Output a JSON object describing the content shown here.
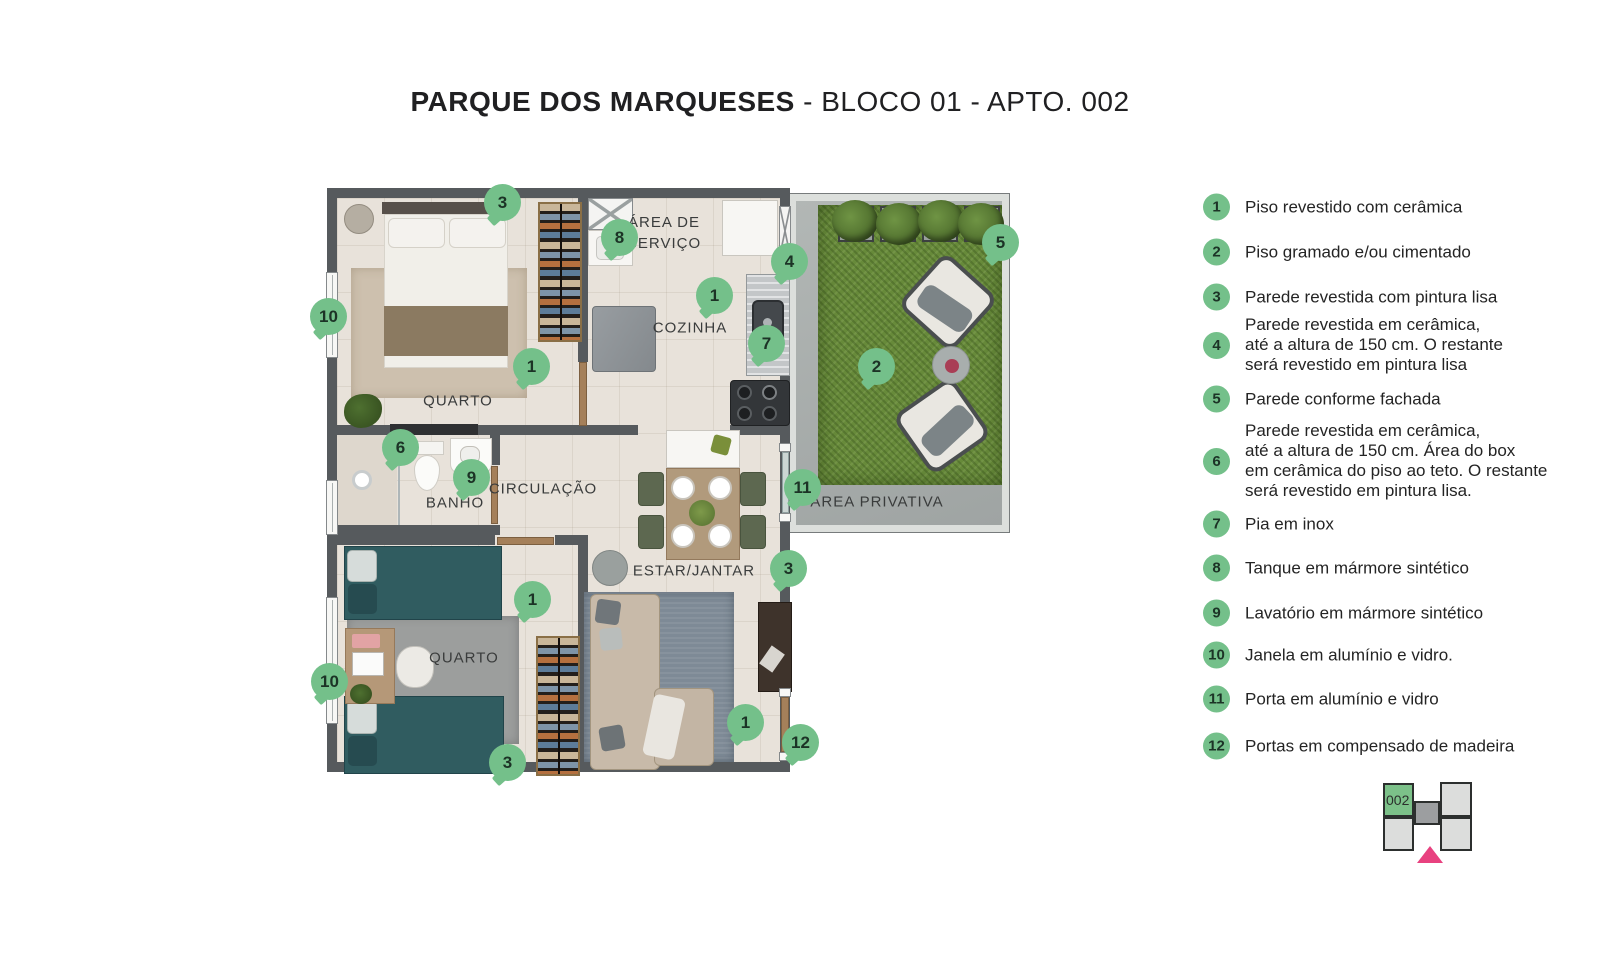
{
  "title": {
    "project": "PARQUE DOS MARQUESES",
    "suffix": " - BLOCO 01 - APTO. 002"
  },
  "colors": {
    "marker_green": "#74c08a",
    "grass_green": "#678a3a",
    "wall_gray": "#565a5d",
    "keyplan_pink": "#e8417f"
  },
  "plan": {
    "room_labels": [
      {
        "id": "area-servico",
        "text": "ÁREA DE\nSERVIÇO",
        "x": 664,
        "y": 233
      },
      {
        "id": "cozinha",
        "text": "COZINHA",
        "x": 690,
        "y": 328
      },
      {
        "id": "quarto-1",
        "text": "QUARTO",
        "x": 458,
        "y": 401
      },
      {
        "id": "banho",
        "text": "BANHO",
        "x": 455,
        "y": 503
      },
      {
        "id": "circulacao",
        "text": "CIRCULAÇÃO",
        "x": 543,
        "y": 489
      },
      {
        "id": "estar-jantar",
        "text": "ESTAR/JANTAR",
        "x": 694,
        "y": 571
      },
      {
        "id": "quarto-2",
        "text": "QUARTO",
        "x": 464,
        "y": 658
      },
      {
        "id": "area-privativa",
        "text": "ÁREA PRIVATIVA",
        "x": 877,
        "y": 502
      }
    ],
    "markers": [
      {
        "n": "3",
        "x": 502,
        "y": 202
      },
      {
        "n": "8",
        "x": 619,
        "y": 237
      },
      {
        "n": "4",
        "x": 789,
        "y": 261
      },
      {
        "n": "5",
        "x": 1000,
        "y": 242
      },
      {
        "n": "1",
        "x": 714,
        "y": 295
      },
      {
        "n": "10",
        "x": 328,
        "y": 316
      },
      {
        "n": "7",
        "x": 766,
        "y": 343
      },
      {
        "n": "1",
        "x": 531,
        "y": 366
      },
      {
        "n": "2",
        "x": 876,
        "y": 366
      },
      {
        "n": "6",
        "x": 400,
        "y": 447
      },
      {
        "n": "9",
        "x": 471,
        "y": 477
      },
      {
        "n": "11",
        "x": 802,
        "y": 487
      },
      {
        "n": "3",
        "x": 788,
        "y": 568
      },
      {
        "n": "1",
        "x": 532,
        "y": 599
      },
      {
        "n": "10",
        "x": 329,
        "y": 681
      },
      {
        "n": "1",
        "x": 745,
        "y": 722
      },
      {
        "n": "12",
        "x": 800,
        "y": 742
      },
      {
        "n": "3",
        "x": 507,
        "y": 762
      }
    ]
  },
  "legend": {
    "items": [
      {
        "num": "1",
        "y": 207,
        "text": "Piso revestido com cerâmica"
      },
      {
        "num": "2",
        "y": 252,
        "text": "Piso gramado e/ou cimentado"
      },
      {
        "num": "3",
        "y": 297,
        "text": "Parede revestida com pintura lisa"
      },
      {
        "num": "4",
        "y": 345,
        "text": "Parede revestida em cerâmica,\naté a altura de 150 cm. O restante\nserá revestido em pintura lisa"
      },
      {
        "num": "5",
        "y": 399,
        "text": "Parede conforme fachada"
      },
      {
        "num": "6",
        "y": 461,
        "text": "Parede revestida em cerâmica,\naté a altura de 150 cm. Área do box\nem cerâmica do piso ao teto. O restante\nserá revestido em pintura lisa."
      },
      {
        "num": "7",
        "y": 524,
        "text": "Pia em inox"
      },
      {
        "num": "8",
        "y": 568,
        "text": "Tanque em mármore sintético"
      },
      {
        "num": "9",
        "y": 613,
        "text": "Lavatório em mármore sintético"
      },
      {
        "num": "10",
        "y": 655,
        "text": "Janela em alumínio e vidro."
      },
      {
        "num": "11",
        "y": 699,
        "text": "Porta em alumínio e vidro"
      },
      {
        "num": "12",
        "y": 746,
        "text": "Portas em compensado de madeira"
      }
    ]
  },
  "keyplan": {
    "unit": "002"
  }
}
